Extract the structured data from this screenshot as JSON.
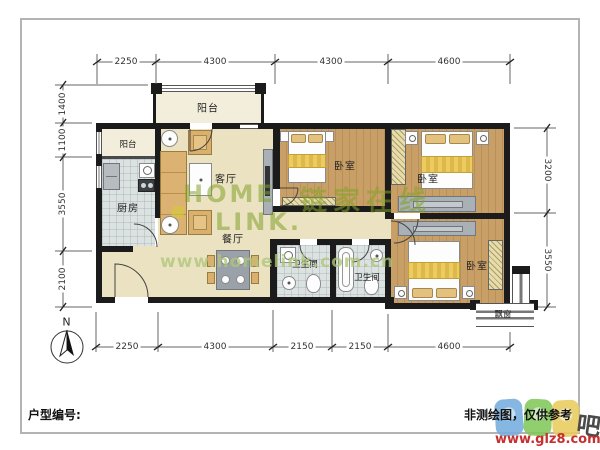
{
  "rooms": {
    "balcony_top": {
      "label": "阳台"
    },
    "balcony_left": {
      "label": "阳台"
    },
    "kitchen": {
      "label": "厨房"
    },
    "living": {
      "label": "客厅"
    },
    "dining": {
      "label": "餐厅"
    },
    "bedroom_mid": {
      "label": "卧室"
    },
    "bedroom_topright": {
      "label": "卧室"
    },
    "bedroom_bottomright": {
      "label": "卧室"
    },
    "bath_left": {
      "label": "卫生间"
    },
    "bath_right": {
      "label": "卫生间"
    },
    "bay_window": {
      "label": "飘窗"
    }
  },
  "dimensions": {
    "top": [
      "2250",
      "4300",
      "4300",
      "4600"
    ],
    "bottom": [
      "2250",
      "4300",
      "2150",
      "2150",
      "4600"
    ],
    "left": [
      "1400",
      "1100",
      "3550",
      "2100"
    ],
    "right": [
      "3200",
      "3550"
    ]
  },
  "compass": {
    "north": "N"
  },
  "footer": {
    "unit_no_label": "户型编号:",
    "disclaimer": "非测绘图，仅供参考"
  },
  "watermarks": {
    "brand_top": "HOME",
    "brand_bottom": "LINK.",
    "brand_cn": "链家在线",
    "brand_url": "www.homelink.com.cn",
    "site_url": "www.glz8.com",
    "site_char": "吧"
  },
  "colors": {
    "wall": "#1b1b1b",
    "wood_floor": "#c89f66",
    "cream_floor": "#ebe2c2",
    "tile_floor": "#dce2e1",
    "brand_green": "#82a02a",
    "url_green": "#b0c57a",
    "site_red": "#c53030",
    "bubble_blue": "#76aee0",
    "bubble_green": "#82c85a",
    "bubble_yellow": "#e8cc5e"
  }
}
